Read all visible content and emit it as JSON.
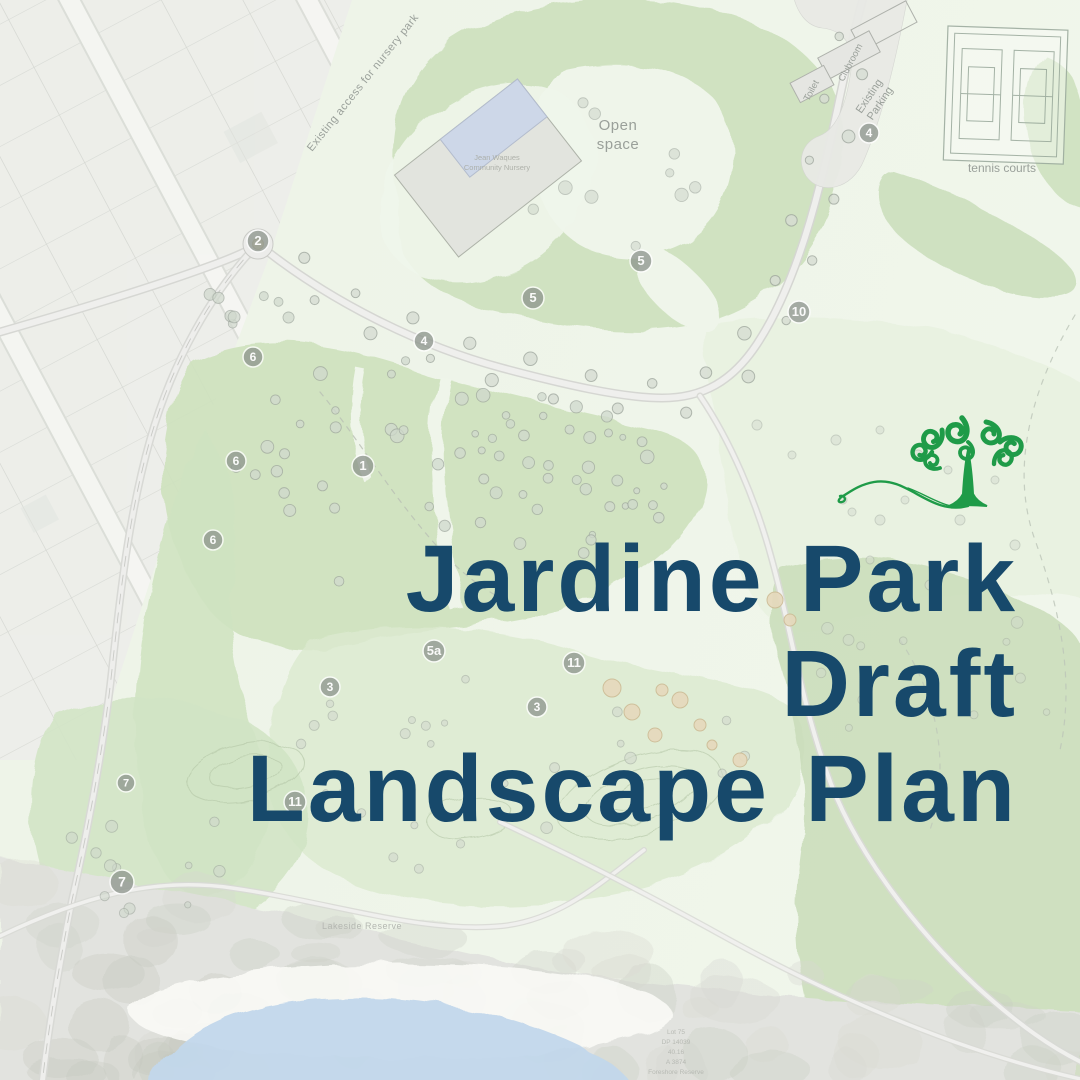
{
  "page": {
    "background": "#eef4e9"
  },
  "title": {
    "lines": [
      "Jardine Park",
      "Draft",
      "Landscape Plan"
    ],
    "color": "#17496b"
  },
  "logo": {
    "name": "swirly-tree-logo",
    "color": "#1f9b48"
  },
  "map": {
    "labels": {
      "open_space_line1": "Open",
      "open_space_line2": "space",
      "tennis_courts": "tennis courts",
      "toilet": "Toilet",
      "clubroom": "Clubroom",
      "existing_parking_line1": "Existing",
      "existing_parking_line2": "Parking",
      "access_road": "Existing access for nursery park",
      "nursery_line1": "Jean Waques",
      "nursery_line2": "Community Nursery",
      "lakeside_reserve": "Lakeside Reserve"
    },
    "survey_note_lines": [
      "Lot 75",
      "DP 14039",
      "40.16",
      "A 3874",
      "Foreshore Reserve"
    ],
    "markers": [
      {
        "label": "2",
        "x": 258,
        "y": 241,
        "r": 11
      },
      {
        "label": "4",
        "x": 424,
        "y": 341,
        "r": 10
      },
      {
        "label": "5",
        "x": 533,
        "y": 298,
        "r": 11
      },
      {
        "label": "5",
        "x": 641,
        "y": 261,
        "r": 11
      },
      {
        "label": "4",
        "x": 869,
        "y": 133,
        "r": 10
      },
      {
        "label": "10",
        "x": 799,
        "y": 312,
        "r": 11
      },
      {
        "label": "6",
        "x": 253,
        "y": 357,
        "r": 10
      },
      {
        "label": "6",
        "x": 236,
        "y": 461,
        "r": 10
      },
      {
        "label": "6",
        "x": 213,
        "y": 540,
        "r": 10
      },
      {
        "label": "1",
        "x": 363,
        "y": 466,
        "r": 11
      },
      {
        "label": "5a",
        "x": 434,
        "y": 651,
        "r": 11
      },
      {
        "label": "11",
        "x": 574,
        "y": 663,
        "r": 11
      },
      {
        "label": "3",
        "x": 330,
        "y": 687,
        "r": 10
      },
      {
        "label": "3",
        "x": 537,
        "y": 707,
        "r": 10
      },
      {
        "label": "7",
        "x": 126,
        "y": 783,
        "r": 9
      },
      {
        "label": "7",
        "x": 122,
        "y": 882,
        "r": 12
      },
      {
        "label": "11",
        "x": 295,
        "y": 802,
        "r": 11
      }
    ],
    "colors": {
      "green_mid": "#cde1bd",
      "green_light": "#dcead0",
      "road_fill": "#efefed",
      "road_casing": "#d6d7d3",
      "water": "#c2d7eb",
      "marker_fill": "#8f978f",
      "label_gray": "#9aa09a",
      "lots_gray": "#ebebe9"
    }
  }
}
